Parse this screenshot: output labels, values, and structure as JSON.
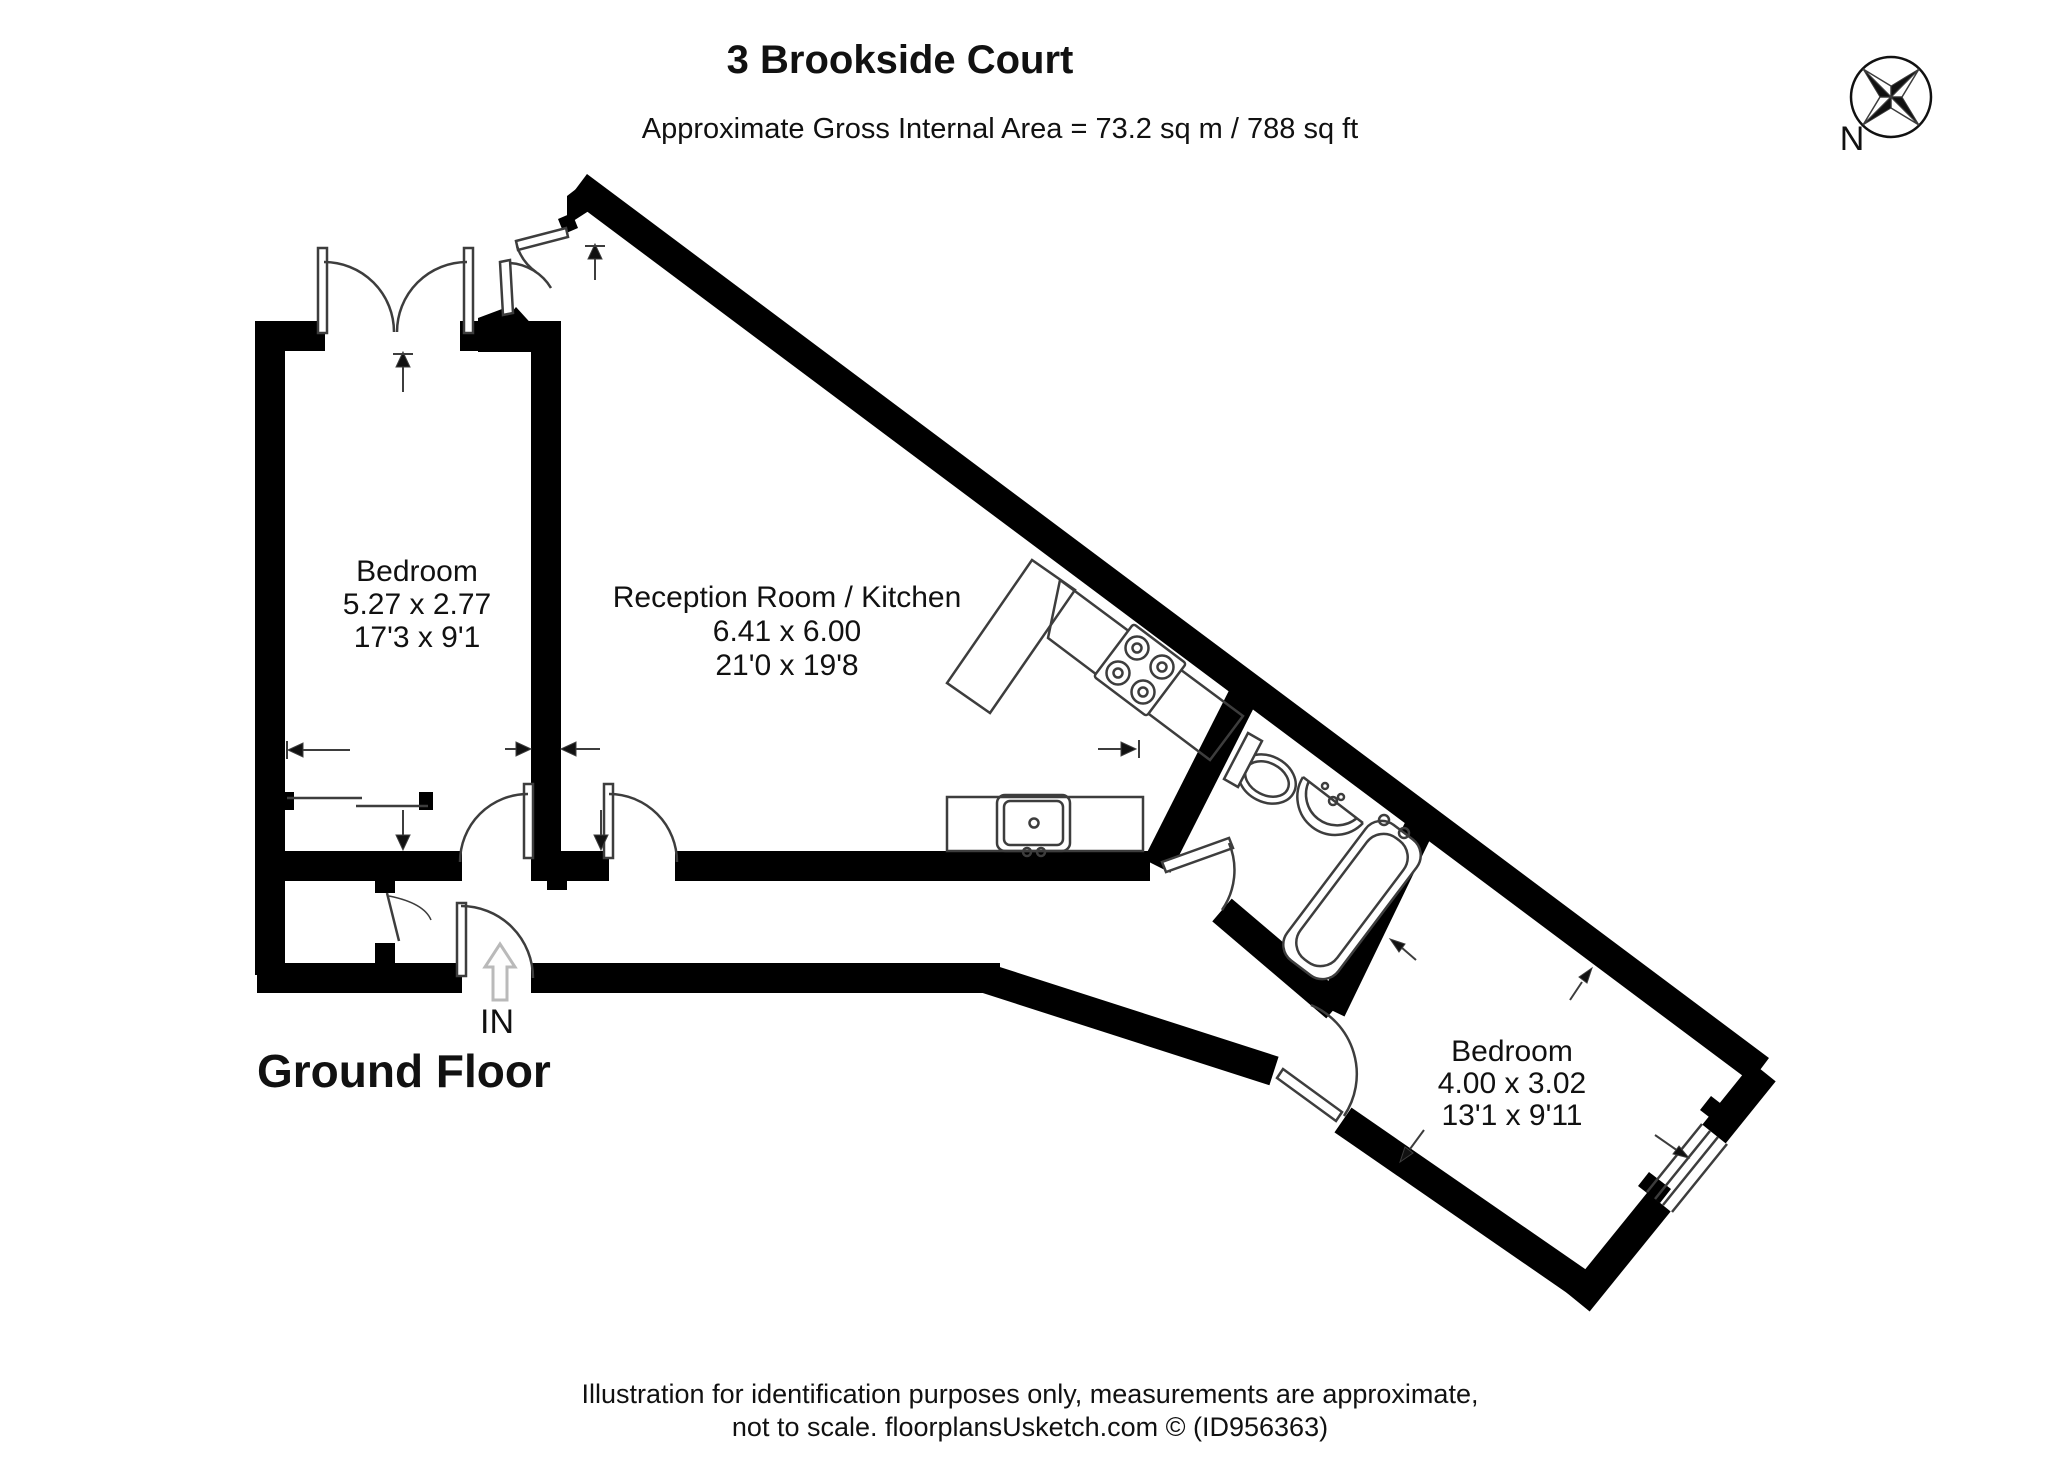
{
  "header": {
    "title": "3 Brookside Court",
    "subtitle": "Approximate Gross Internal Area = 73.2 sq m / 788 sq ft"
  },
  "compass": {
    "north_label": "N"
  },
  "floor_label": "Ground Floor",
  "entrance_label": "IN",
  "rooms": [
    {
      "name": "Bedroom",
      "metric": "5.27 x 2.77",
      "imperial": "17'3 x 9'1"
    },
    {
      "name": "Reception Room / Kitchen",
      "metric": "6.41 x 6.00",
      "imperial": "21'0 x 19'8"
    },
    {
      "name": "Bedroom",
      "metric": "4.00 x 3.02",
      "imperial": "13'1 x 9'11"
    }
  ],
  "footer": {
    "line1": "Illustration for identification purposes only, measurements are approximate,",
    "line2": "not to scale. floorplansUsketch.com © (ID956363)"
  },
  "colors": {
    "wall": "#000000",
    "thin": "#3d3d3d",
    "light": "#b9b9b9",
    "paper": "#ffffff"
  },
  "floorplan": {
    "walls": [
      {
        "d": "M 270 975 L 270 338"
      },
      {
        "d": "M 255 336 L 325 336"
      },
      {
        "d": "M 460 336 L 561 336"
      },
      {
        "d": "M 546 323 L 546 868"
      },
      {
        "d": "M 257 866 L 462 866"
      },
      {
        "d": "M 531 866 L 609 866"
      },
      {
        "d": "M 675 866 L 1150 866"
      },
      {
        "d": "M 257 978 L 462 978"
      },
      {
        "d": "M 531 978 L 1000 978"
      },
      {
        "d": "M 985 978 L 1274 1071"
      },
      {
        "d": "M 1343 1120 L 1592 1292"
      },
      {
        "d": "M 1578 1302 L 1659 1202"
      },
      {
        "d": "M 1714 1134 L 1764 1072"
      },
      {
        "d": "M 578 186 L 1760 1070"
      },
      {
        "d": "M 1243 696 L 1157 866"
      },
      {
        "d": "M 1222 910 L 1336 1007"
      },
      {
        "d": "M 1419 828 L 1331 1010"
      },
      {
        "d": "M 557 868 L 557 890",
        "w": 20
      },
      {
        "d": "M 385 868 L 385 893",
        "w": 20
      },
      {
        "d": "M 385 943 L 385 966",
        "w": 20
      }
    ],
    "fills": [
      {
        "d": "M 567 196 L 589 179 L 612 196 L 567 225 Z"
      },
      {
        "d": "M 558 219 L 572 213 L 578 228 L 564 234 Z"
      },
      {
        "d": "M 492 336 L 516 307 L 536 329 Z"
      },
      {
        "d": "M 478 318 L 510 306 L 531 330 L 531 352 L 478 352 Z"
      },
      {
        "d": "M 280 792 L 294 792 L 294 810 L 280 810 Z"
      },
      {
        "d": "M 419 792 L 433 792 L 433 810 L 419 810 Z"
      },
      {
        "d": "M 1638 1186 L 1660 1203 L 1671 1189 L 1649 1172 Z"
      },
      {
        "d": "M 1700 1110 L 1722 1127 L 1733 1113 L 1711 1096 Z"
      }
    ],
    "thin": [
      {
        "d": "M 287 798 L 362 798"
      },
      {
        "d": "M 356 806 L 428 806"
      },
      {
        "d": "M 318 248 L 327 248 L 327 333 L 318 333 Z",
        "f": "#ffffff"
      },
      {
        "d": "M 464 248 L 473 248 L 473 333 L 464 333 Z",
        "f": "#ffffff"
      },
      {
        "d": "M 324 262 A 70 70 0 0 1 394 332"
      },
      {
        "d": "M 467 262 A 70 70 0 0 0 397 332"
      },
      {
        "d": "M 516 241 L 566 228 L 568 237 L 518 250 Z",
        "f": "#ffffff"
      },
      {
        "d": "M 517 246 A 51 51 0 0 0 536 272"
      },
      {
        "d": "M 500 262 L 510 260 L 513 313 L 503 315 Z",
        "f": "#ffffff"
      },
      {
        "d": "M 510 263 A 52 52 0 0 1 551 288"
      },
      {
        "d": "M 524 784 L 533 784 L 533 858 L 524 858 Z",
        "f": "#ffffff"
      },
      {
        "d": "M 460 862 A 68 68 0 0 1 528 794"
      },
      {
        "d": "M 604 784 L 613 784 L 613 858 L 604 858 Z",
        "f": "#ffffff"
      },
      {
        "d": "M 609 794 A 68 68 0 0 1 677 862"
      },
      {
        "d": "M 387 893 L 399 941"
      },
      {
        "d": "M 389 896 Q 424 903 431 920",
        "w": 1.5
      },
      {
        "d": "M 457 903 L 466 903 L 466 976 L 457 976 Z",
        "f": "#ffffff"
      },
      {
        "d": "M 461 906 A 72 72 0 0 1 533 978"
      },
      {
        "d": "M 1162 862 L 1229 838 L 1233 848 L 1166 872 Z",
        "f": "#ffffff"
      },
      {
        "d": "M 1229 843 A 70 70 0 0 1 1222 910"
      },
      {
        "d": "M 1283 1069 L 1342 1112 L 1336 1121 L 1277 1078 Z",
        "f": "#ffffff"
      },
      {
        "d": "M 1311 1005 A 75 75 0 0 1 1344 1116"
      },
      {
        "d": "M 1647 1192 L 1702 1124"
      },
      {
        "d": "M 1655 1199 L 1710 1131"
      },
      {
        "d": "M 1663 1205 L 1718 1137"
      },
      {
        "d": "M 1672 1212 L 1727 1144"
      },
      {
        "d": "M 1032 560 L 947 683 L 990 713 L 1075 590 Z"
      },
      {
        "d": "M 1060 580 L 1243 716 L 1210 760 L 1048 638 Z"
      },
      {
        "r": [
          947,
          797,
          196,
          54,
          0
        ]
      },
      {
        "r": [
          997,
          795,
          73,
          56,
          8
        ]
      },
      {
        "r": [
          1004,
          801,
          59,
          44,
          6
        ]
      },
      {
        "c": [
          1034,
          823,
          4.5
        ]
      },
      {
        "c": [
          1027,
          852,
          4
        ]
      },
      {
        "c": [
          1041,
          852,
          4
        ]
      },
      {
        "r": [
          1107,
          637,
          66,
          66,
          3
        ],
        "t": "rotate(37 1140 670)",
        "f": "#ffffff"
      },
      {
        "c": [
          1143,
          692,
          11.5
        ]
      },
      {
        "c": [
          1162,
          667,
          11.5
        ]
      },
      {
        "c": [
          1118,
          673,
          11.5
        ]
      },
      {
        "c": [
          1137,
          648,
          11.5
        ]
      },
      {
        "c": [
          1143,
          692,
          4.5
        ]
      },
      {
        "c": [
          1162,
          667,
          4.5
        ]
      },
      {
        "c": [
          1118,
          673,
          4.5
        ]
      },
      {
        "c": [
          1137,
          648,
          4.5
        ]
      },
      {
        "e": [
          1267,
          779,
          30,
          23
        ],
        "t": "rotate(27 1267 779)",
        "f": "#ffffff"
      },
      {
        "e": [
          1267,
          779,
          23,
          16
        ],
        "t": "rotate(27 1267 779)"
      },
      {
        "d": "M 1238 787 L 1224 779 L 1248 733 L 1262 741 Z",
        "f": "#ffffff"
      },
      {
        "d": "M 1303 777 A 38 38 0 0 0 1363 823",
        "f": "#ffffff"
      },
      {
        "d": "M 1303 777 L 1363 823"
      },
      {
        "d": "M 1309 781 A 31 31 0 0 0 1357 818"
      },
      {
        "c": [
          1333,
          801,
          4
        ]
      },
      {
        "c": [
          1325,
          786,
          3
        ]
      },
      {
        "c": [
          1341,
          797,
          3
        ]
      },
      {
        "r": [
          1320,
          815,
          64,
          170,
          20
        ],
        "t": "rotate(37 1352 900)",
        "f": "#ffffff"
      },
      {
        "r": [
          1329,
          824,
          46,
          152,
          21
        ],
        "t": "rotate(37 1352 900)"
      },
      {
        "c": [
          1384,
          820,
          5
        ]
      },
      {
        "c": [
          1404,
          833,
          5
        ]
      },
      {
        "d": "M 403 392 L 403 360",
        "w": 2
      },
      {
        "d": "M 403 352 L 396 367 L 410 367 Z",
        "f": "#111111",
        "w": 1
      },
      {
        "d": "M 393 354 L 413 354",
        "w": 2
      },
      {
        "d": "M 595 280 L 595 252",
        "w": 2
      },
      {
        "d": "M 595 244 L 588 259 L 602 259 Z",
        "f": "#111111",
        "w": 1
      },
      {
        "d": "M 585 246 L 605 246",
        "w": 2
      },
      {
        "d": "M 350 750 L 302 750",
        "w": 2
      },
      {
        "d": "M 288 750 L 303 743 L 303 757 Z",
        "f": "#111111",
        "w": 1
      },
      {
        "d": "M 287 741 L 287 759",
        "w": 2
      },
      {
        "d": "M 505 749 L 520 749",
        "w": 2
      },
      {
        "d": "M 531 749 L 516 742 L 516 756 Z",
        "f": "#111111",
        "w": 1
      },
      {
        "d": "M 575 749 L 600 749",
        "w": 2
      },
      {
        "d": "M 561 749 L 576 742 L 576 756 Z",
        "f": "#111111",
        "w": 1
      },
      {
        "d": "M 403 810 L 403 840",
        "w": 2
      },
      {
        "d": "M 403 850 L 396 835 L 410 835 Z",
        "f": "#111111",
        "w": 1
      },
      {
        "d": "M 601 810 L 601 840",
        "w": 2
      },
      {
        "d": "M 601 850 L 594 835 L 608 835 Z",
        "f": "#111111",
        "w": 1
      },
      {
        "d": "M 1098 749 L 1126 749",
        "w": 2
      },
      {
        "d": "M 1136 749 L 1121 742 L 1121 756 Z",
        "f": "#111111",
        "w": 1
      },
      {
        "d": "M 1139 740 L 1139 758",
        "w": 2
      },
      {
        "d": "M 1416 960 L 1401 947",
        "w": 2
      },
      {
        "d": "M 1390 939 L 1399 952 L 1405 944 Z",
        "f": "#111111",
        "w": 1
      },
      {
        "d": "M 1570 1000 L 1582 982",
        "w": 2
      },
      {
        "d": "M 1592 968 L 1587 983 L 1579 977 Z",
        "f": "#111111",
        "w": 1
      },
      {
        "d": "M 1655 1135 L 1678 1151",
        "w": 2
      },
      {
        "d": "M 1689 1158 L 1673 1154 L 1679 1146 Z",
        "f": "#111111",
        "w": 1
      },
      {
        "d": "M 1424 1130 L 1410 1149",
        "w": 2
      },
      {
        "d": "M 1400 1162 L 1405 1147 L 1413 1153 Z",
        "f": "#111111",
        "w": 1
      },
      {
        "c": [
          1891,
          97,
          40
        ],
        "w": 2.5,
        "s": "#111111"
      },
      {
        "d": "M 1891 97 L 1919 69 L 1902 97 Z",
        "w": 1.5
      },
      {
        "d": "M 1891 97 L 1919 125 L 1891 108 Z",
        "w": 1.5
      },
      {
        "d": "M 1891 97 L 1863 125 L 1880 97 Z",
        "w": 1.5
      },
      {
        "d": "M 1891 97 L 1863 69 L 1891 86 Z",
        "w": 1.5
      },
      {
        "d": "M 1891 97 L 1891 86 L 1919 69 Z",
        "f": "#111111",
        "w": 1
      },
      {
        "d": "M 1891 97 L 1902 97 L 1919 125 Z",
        "f": "#111111",
        "w": 1
      },
      {
        "d": "M 1891 97 L 1891 108 L 1863 125 Z",
        "f": "#111111",
        "w": 1
      },
      {
        "d": "M 1891 97 L 1880 97 L 1863 69 Z",
        "f": "#111111",
        "w": 1
      }
    ],
    "light": [
      {
        "d": "M 500 944 L 515 967 L 507 967 L 507 1000 L 493 1000 L 493 967 L 485 967 Z"
      }
    ]
  }
}
